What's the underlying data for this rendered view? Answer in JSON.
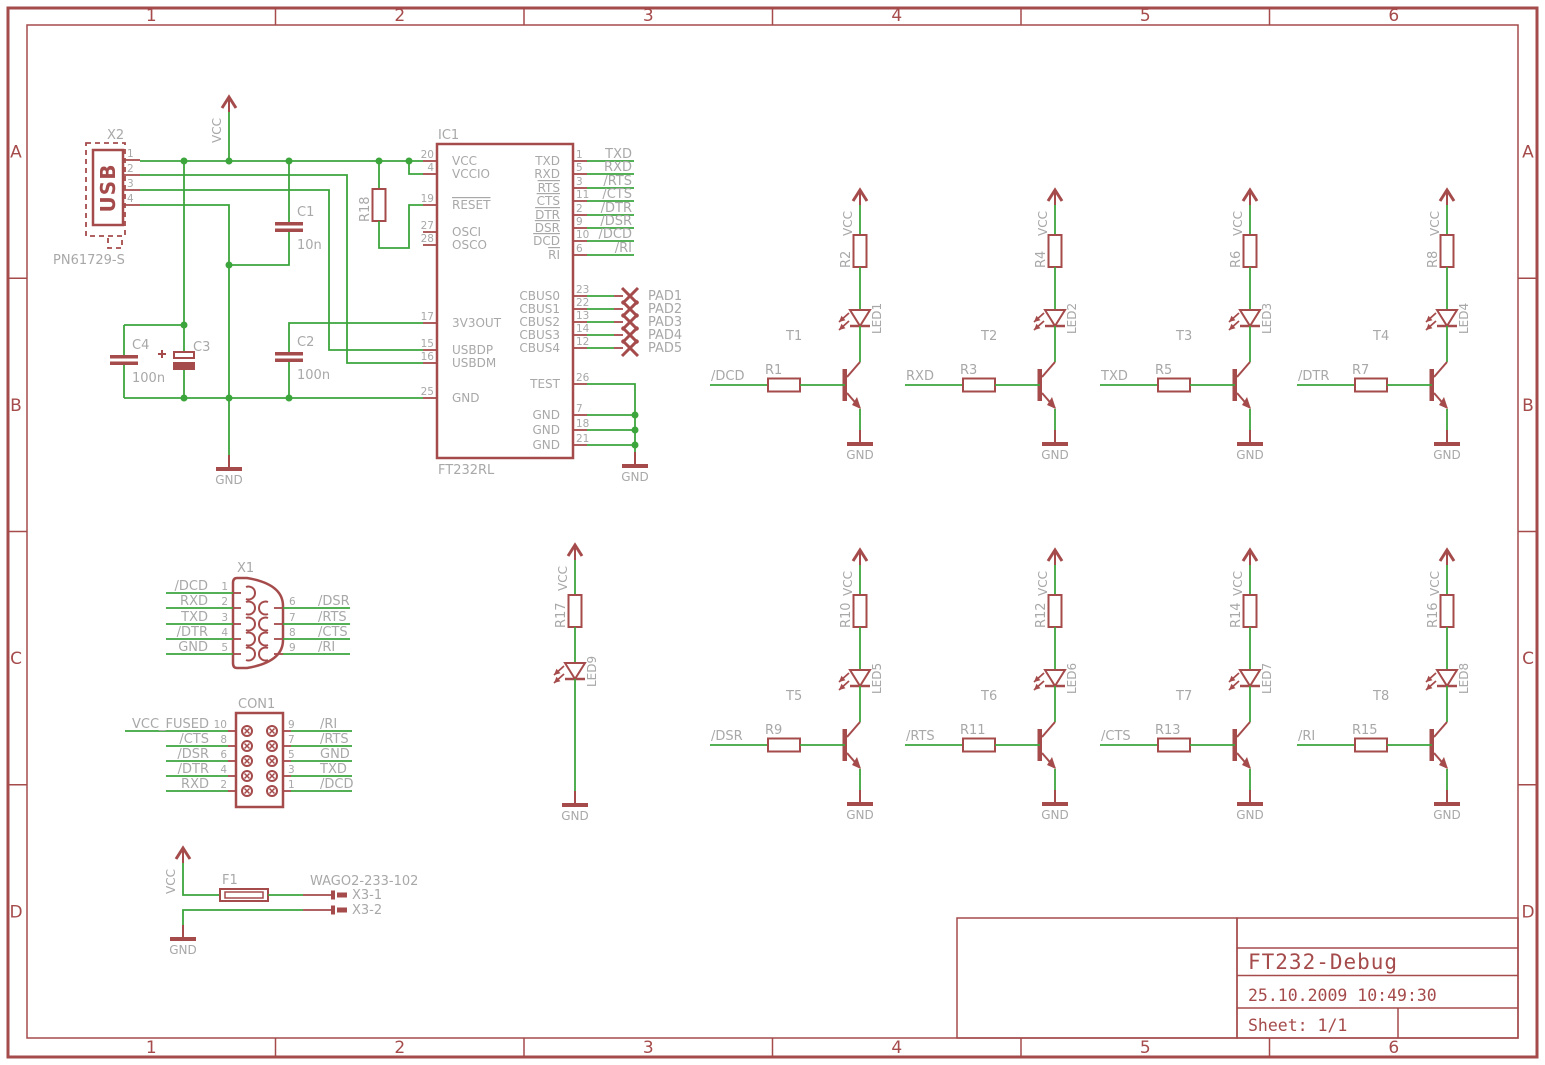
{
  "colors": {
    "symbol": "#a54b4b",
    "wire": "#3ca53c",
    "label": "#a8a8a8"
  },
  "sheet": {
    "cols": [
      "1",
      "2",
      "3",
      "4",
      "5",
      "6"
    ],
    "rows": [
      "A",
      "B",
      "C",
      "D"
    ]
  },
  "title_block": {
    "title": "FT232-Debug",
    "date": "25.10.2009 10:49:30",
    "sheet": "Sheet: 1/1"
  },
  "power": {
    "vcc": "VCC",
    "gnd": "GND"
  },
  "usb": {
    "ref": "X2",
    "label": "USB",
    "package": "PN61729-S",
    "pins": [
      "1",
      "2",
      "3",
      "4"
    ]
  },
  "r18": {
    "ref": "R18"
  },
  "caps": {
    "c1": {
      "ref": "C1",
      "val": "10n"
    },
    "c2": {
      "ref": "C2",
      "val": "100n"
    },
    "c3": {
      "ref": "C3"
    },
    "c4": {
      "ref": "C4",
      "val": "100n"
    }
  },
  "ic": {
    "ref": "IC1",
    "value": "FT232RL",
    "left_pins": [
      {
        "num": "20",
        "name": "VCC"
      },
      {
        "num": "4",
        "name": "VCCIO"
      },
      {
        "num": "19",
        "name": "RESET",
        "overline": true
      },
      {
        "num": "27",
        "name": "OSCI"
      },
      {
        "num": "28",
        "name": "OSCO"
      },
      {
        "num": "17",
        "name": "3V3OUT"
      },
      {
        "num": "15",
        "name": "USBDP"
      },
      {
        "num": "16",
        "name": "USBDM"
      },
      {
        "num": "25",
        "name": "GND"
      }
    ],
    "uart_pins": [
      {
        "num": "1",
        "name": "TXD",
        "net": "TXD"
      },
      {
        "num": "5",
        "name": "RXD",
        "net": "RXD"
      },
      {
        "num": "3",
        "name": "RTS",
        "overline": true,
        "net": "/RTS"
      },
      {
        "num": "11",
        "name": "CTS",
        "overline": true,
        "net": "/CTS"
      },
      {
        "num": "2",
        "name": "DTR",
        "overline": true,
        "net": "/DTR"
      },
      {
        "num": "9",
        "name": "DSR",
        "overline": true,
        "net": "/DSR"
      },
      {
        "num": "10",
        "name": "DCD",
        "overline": true,
        "net": "/DCD"
      },
      {
        "num": "6",
        "name": "RI",
        "overline": true,
        "net": "/RI"
      }
    ],
    "cbus_pins": [
      {
        "num": "23",
        "name": "CBUS0",
        "pad": "PAD1"
      },
      {
        "num": "22",
        "name": "CBUS1",
        "pad": "PAD2"
      },
      {
        "num": "13",
        "name": "CBUS2",
        "pad": "PAD3"
      },
      {
        "num": "14",
        "name": "CBUS3",
        "pad": "PAD4"
      },
      {
        "num": "12",
        "name": "CBUS4",
        "pad": "PAD5"
      }
    ],
    "test_pin": {
      "num": "26",
      "name": "TEST"
    },
    "gnd_pins": [
      {
        "num": "7",
        "name": "GND"
      },
      {
        "num": "18",
        "name": "GND"
      },
      {
        "num": "21",
        "name": "GND"
      }
    ]
  },
  "x1": {
    "ref": "X1",
    "left_pins": [
      {
        "num": "1",
        "net": "/DCD"
      },
      {
        "num": "2",
        "net": "RXD"
      },
      {
        "num": "3",
        "net": "TXD"
      },
      {
        "num": "4",
        "net": "/DTR"
      },
      {
        "num": "5",
        "net": "GND"
      }
    ],
    "right_pins": [
      {
        "num": "6",
        "net": "/DSR"
      },
      {
        "num": "7",
        "net": "/RTS"
      },
      {
        "num": "8",
        "net": "/CTS"
      },
      {
        "num": "9",
        "net": "/RI"
      }
    ]
  },
  "con1": {
    "ref": "CON1",
    "left_pins": [
      {
        "num": "10",
        "net": "VCC_FUSED"
      },
      {
        "num": "8",
        "net": "/CTS"
      },
      {
        "num": "6",
        "net": "/DSR"
      },
      {
        "num": "4",
        "net": "/DTR"
      },
      {
        "num": "2",
        "net": "RXD"
      }
    ],
    "right_pins": [
      {
        "num": "9",
        "net": "/RI"
      },
      {
        "num": "7",
        "net": "/RTS"
      },
      {
        "num": "5",
        "net": "GND"
      },
      {
        "num": "3",
        "net": "TXD"
      },
      {
        "num": "1",
        "net": "/DCD"
      }
    ]
  },
  "fuse": {
    "ref": "F1",
    "part": "WAGO2-233-102",
    "terminals": [
      {
        "name": "X3-1"
      },
      {
        "name": "X3-2"
      }
    ]
  },
  "drivers": [
    {
      "t": "T1",
      "input": "/DCD",
      "rb": "R1",
      "rc": "R2",
      "led": "LED1"
    },
    {
      "t": "T2",
      "input": "RXD",
      "rb": "R3",
      "rc": "R4",
      "led": "LED2"
    },
    {
      "t": "T3",
      "input": "TXD",
      "rb": "R5",
      "rc": "R6",
      "led": "LED3"
    },
    {
      "t": "T4",
      "input": "/DTR",
      "rb": "R7",
      "rc": "R8",
      "led": "LED4"
    },
    {
      "t": "T5",
      "input": "/DSR",
      "rb": "R9",
      "rc": "R10",
      "led": "LED5"
    },
    {
      "t": "T6",
      "input": "/RTS",
      "rb": "R11",
      "rc": "R12",
      "led": "LED6"
    },
    {
      "t": "T7",
      "input": "/CTS",
      "rb": "R13",
      "rc": "R14",
      "led": "LED7"
    },
    {
      "t": "T8",
      "input": "/RI",
      "rb": "R15",
      "rc": "R16",
      "led": "LED8"
    }
  ],
  "led9": {
    "r": "R17",
    "led": "LED9"
  }
}
